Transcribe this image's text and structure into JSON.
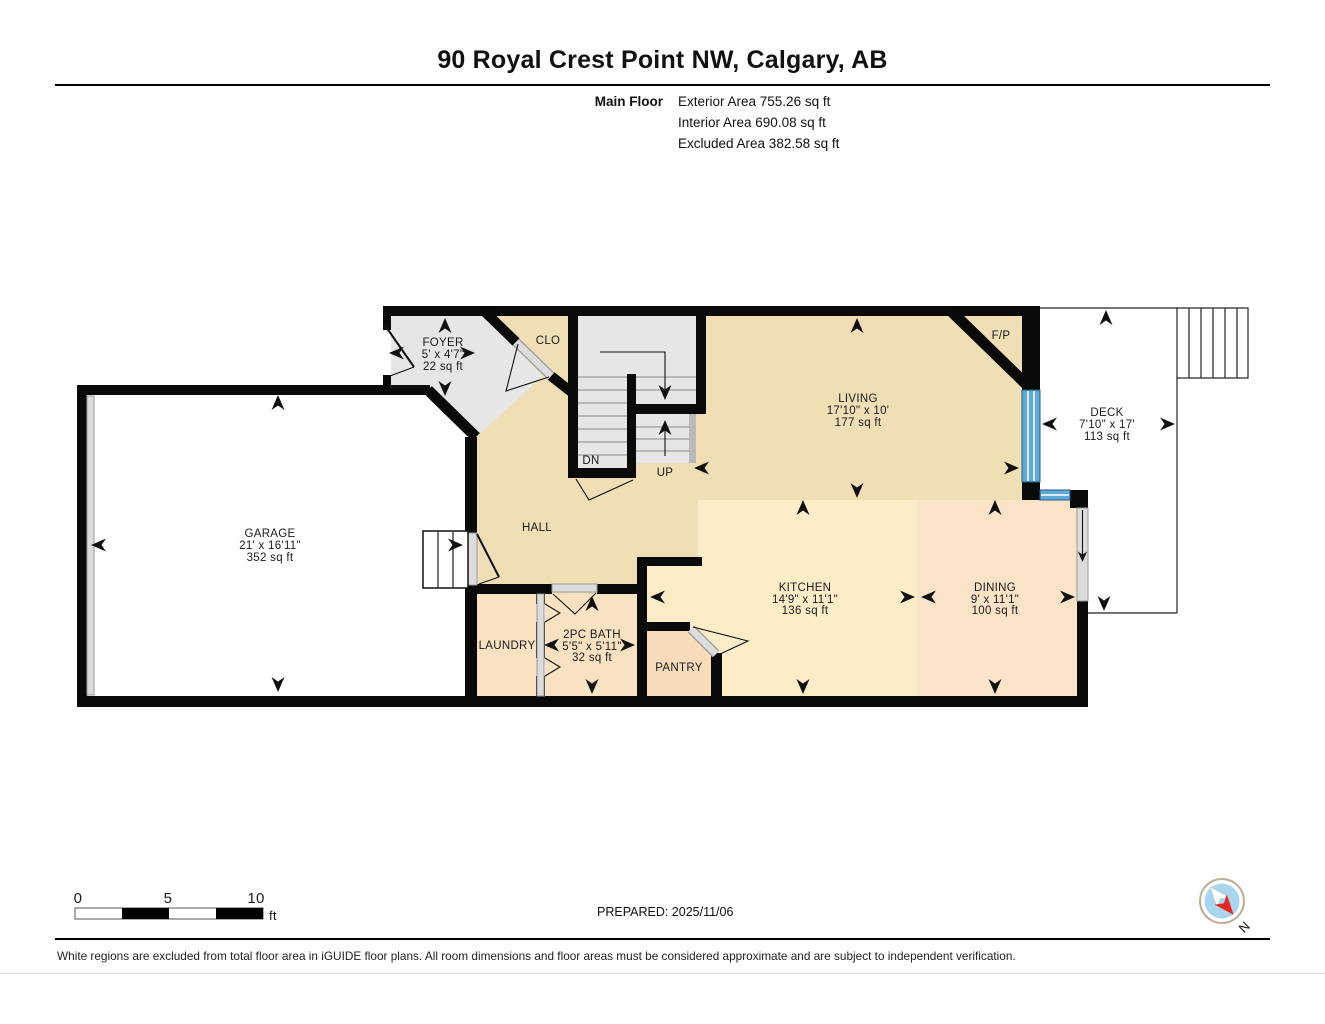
{
  "header": {
    "title": "90 Royal Crest Point NW, Calgary, AB",
    "floor_label": "Main Floor",
    "exterior_area": "Exterior Area 755.26 sq ft",
    "interior_area": "Interior Area 690.08 sq ft",
    "excluded_area": "Excluded Area 382.58 sq ft"
  },
  "rooms": {
    "garage": {
      "name": "GARAGE",
      "dims": "21' x 16'11\"",
      "area": "352 sq ft"
    },
    "foyer": {
      "name": "FOYER",
      "dims": "5' x 4'7\"",
      "area": "22 sq ft"
    },
    "closet": {
      "name": "CLO"
    },
    "living": {
      "name": "LIVING",
      "dims": "17'10\" x 10'",
      "area": "177 sq ft"
    },
    "deck": {
      "name": "DECK",
      "dims": "7'10\" x 17'",
      "area": "113 sq ft"
    },
    "kitchen": {
      "name": "KITCHEN",
      "dims": "14'9\" x 11'1\"",
      "area": "136 sq ft"
    },
    "dining": {
      "name": "DINING",
      "dims": "9' x 11'1\"",
      "area": "100 sq ft"
    },
    "bath": {
      "name": "2PC BATH",
      "dims": "5'5\" x 5'11\"",
      "area": "32 sq ft"
    },
    "laundry": {
      "name": "LAUNDRY"
    },
    "pantry": {
      "name": "PANTRY"
    },
    "hall": {
      "name": "HALL"
    },
    "fireplace": {
      "name": "F/P"
    },
    "stairs": {
      "down": "DN",
      "up": "UP"
    }
  },
  "scale_bar": {
    "tick0": "0",
    "tick1": "5",
    "tick2": "10",
    "unit": "ft"
  },
  "footer": {
    "prepared": "PREPARED: 2025/11/06",
    "disclaimer": "White regions are excluded from total floor area in iGUIDE floor plans. All room dimensions and floor areas must be considered approximate and are subject to independent verification.",
    "compass_north": "N"
  },
  "colors": {
    "wall": "#0a0a0a",
    "beige": "#f0deb5",
    "kitchen": "#fdecc8",
    "dining": "#fae3c6",
    "service": "#f9e2c2",
    "pantry": "#f8dcba",
    "gray_room": "#e6e6e6",
    "door": "#dcdcdc",
    "door_edge": "#9a9a9a",
    "window": "#5fa8d8",
    "railing": "#b9b9b9",
    "compass_blue": "#a9d6ef",
    "compass_red": "#e8251f",
    "compass_ring": "#bfae94"
  }
}
